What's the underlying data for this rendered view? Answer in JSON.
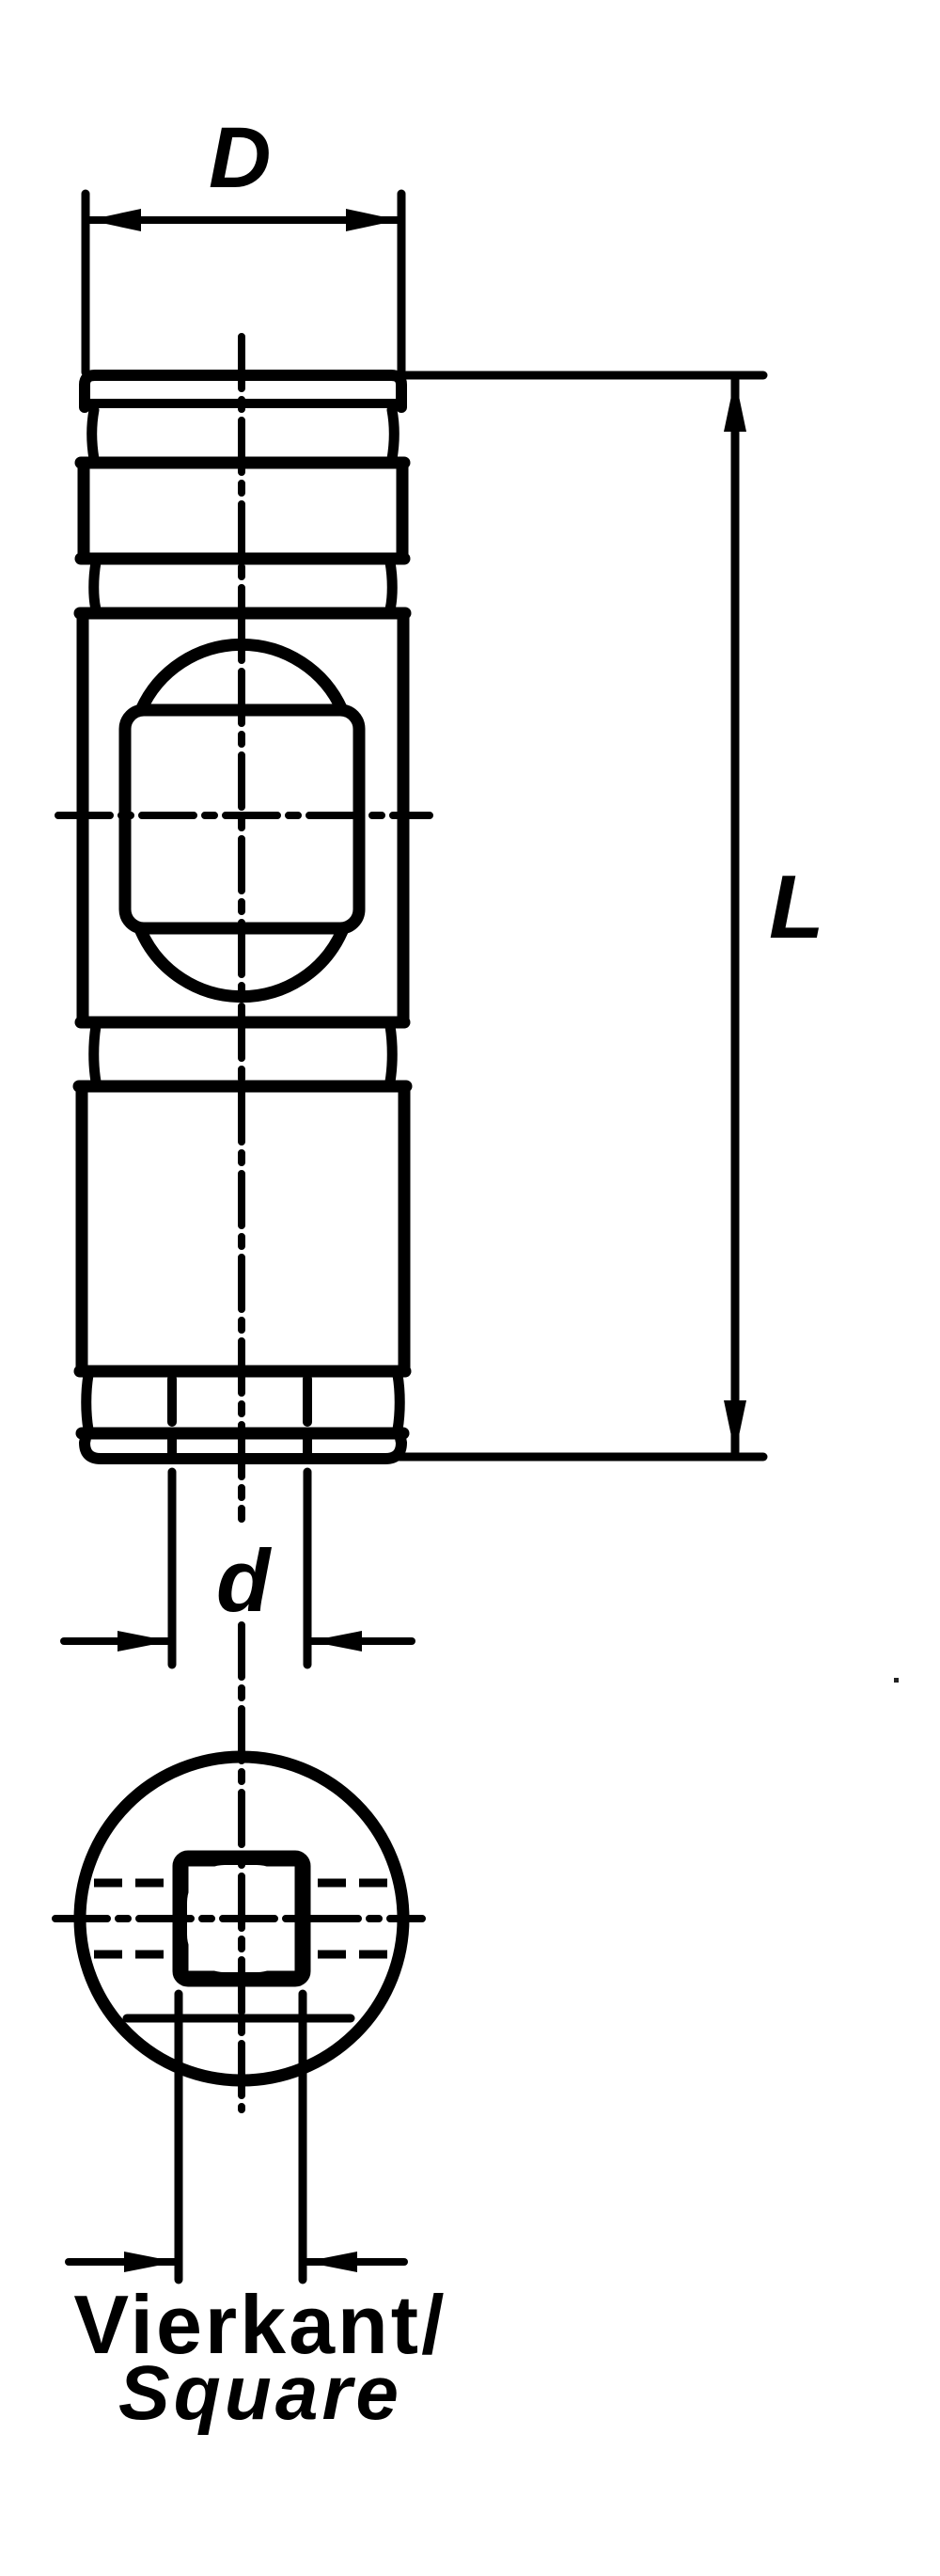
{
  "document": {
    "kind": "technical-drawing",
    "paper_color": "#ffffff",
    "ink_color": "#000000"
  },
  "views": {
    "front_view": "side elevation of cylindrical socket part",
    "bottom_view": "end view: circle with square broach hole"
  },
  "dimensions": {
    "diameter_label": "D",
    "length_label": "L",
    "hole_label": "d",
    "square_caption_de": "Vierkant/",
    "square_caption_en": "Square"
  }
}
